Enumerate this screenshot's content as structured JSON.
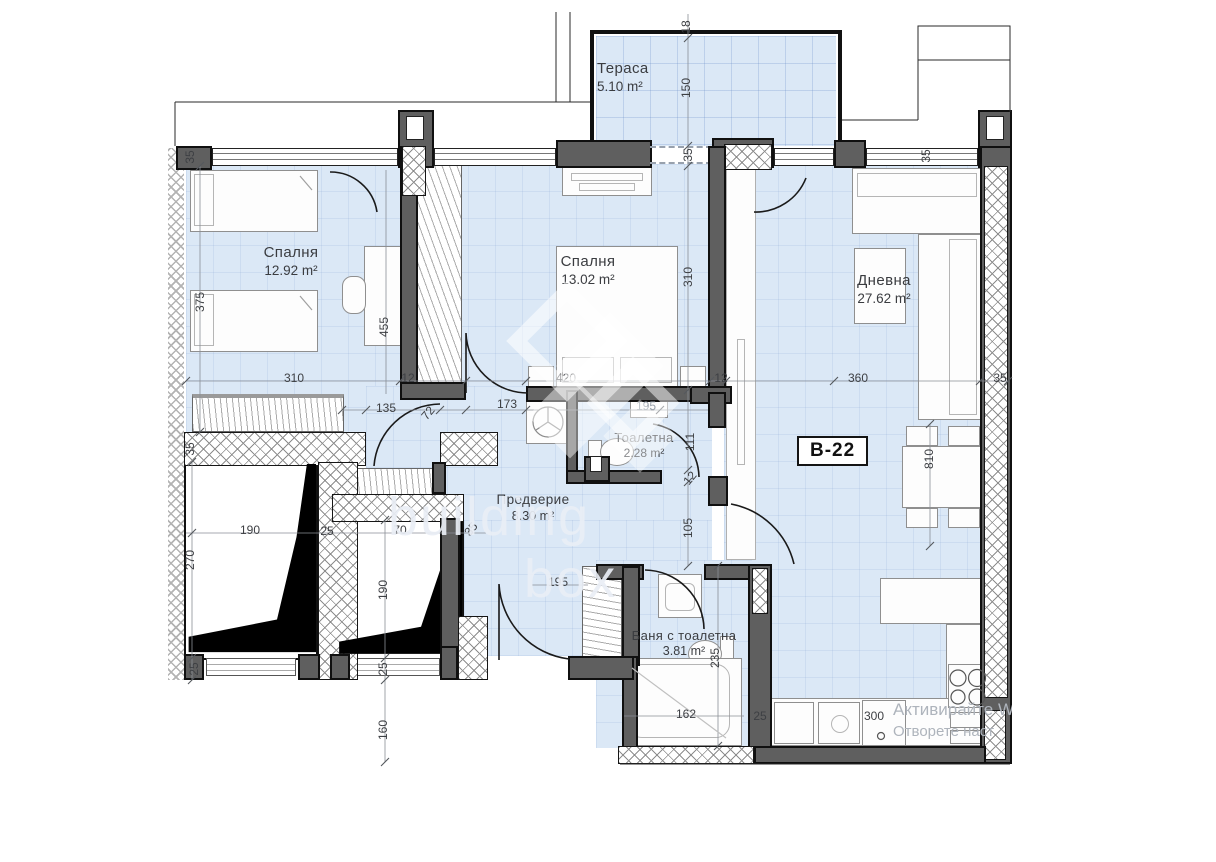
{
  "plan": {
    "unit_label": "B-22",
    "rooms": [
      {
        "name": "Тераса",
        "area": "5.10 m²"
      },
      {
        "name": "Спалня",
        "area": "12.92 m²"
      },
      {
        "name": "Спалня",
        "area": "13.02 m²"
      },
      {
        "name": "Дневна",
        "area": "27.62 m²"
      },
      {
        "name": "Тоалетна",
        "area": "2.28 m²"
      },
      {
        "name": "Предверие",
        "area": "8.30 m²"
      },
      {
        "name": "Баня с тоалетна",
        "area": "3.81 m²"
      }
    ],
    "dimensions": [
      {
        "t": "18",
        "x": 686,
        "y": 27,
        "o": "v"
      },
      {
        "t": "150",
        "x": 686,
        "y": 88,
        "o": "v"
      },
      {
        "t": "35",
        "x": 688,
        "y": 155,
        "o": "v"
      },
      {
        "t": "35",
        "x": 190,
        "y": 157,
        "o": "v"
      },
      {
        "t": "375",
        "x": 200,
        "y": 302,
        "o": "v"
      },
      {
        "t": "455",
        "x": 384,
        "y": 327,
        "o": "v"
      },
      {
        "t": "310",
        "x": 688,
        "y": 277,
        "o": "v"
      },
      {
        "t": "35",
        "x": 926,
        "y": 156,
        "o": "v"
      },
      {
        "t": "310",
        "x": 294,
        "y": 378,
        "o": "h"
      },
      {
        "t": "12",
        "x": 408,
        "y": 378,
        "o": "h"
      },
      {
        "t": "420",
        "x": 566,
        "y": 378,
        "o": "h"
      },
      {
        "t": "12",
        "x": 721,
        "y": 378,
        "o": "h"
      },
      {
        "t": "360",
        "x": 858,
        "y": 378,
        "o": "h"
      },
      {
        "t": "35",
        "x": 1000,
        "y": 378,
        "o": "h"
      },
      {
        "t": "135",
        "x": 386,
        "y": 408,
        "o": "h"
      },
      {
        "t": "72",
        "x": 428,
        "y": 413,
        "o": "d"
      },
      {
        "t": "173",
        "x": 507,
        "y": 404,
        "o": "h"
      },
      {
        "t": "195",
        "x": 646,
        "y": 406,
        "o": "h",
        "gray": true
      },
      {
        "t": "111",
        "x": 690,
        "y": 442,
        "o": "v"
      },
      {
        "t": "12",
        "x": 690,
        "y": 478,
        "o": "d"
      },
      {
        "t": "105",
        "x": 688,
        "y": 528,
        "o": "v"
      },
      {
        "t": "35",
        "x": 190,
        "y": 449,
        "o": "v"
      },
      {
        "t": "190",
        "x": 250,
        "y": 530,
        "o": "h"
      },
      {
        "t": "25",
        "x": 327,
        "y": 531,
        "o": "h"
      },
      {
        "t": "70",
        "x": 400,
        "y": 530,
        "o": "h"
      },
      {
        "t": "35",
        "x": 471,
        "y": 529,
        "o": "d"
      },
      {
        "t": "270",
        "x": 190,
        "y": 560,
        "o": "v"
      },
      {
        "t": "190",
        "x": 383,
        "y": 590,
        "o": "v"
      },
      {
        "t": "25",
        "x": 194,
        "y": 669,
        "o": "v"
      },
      {
        "t": "25",
        "x": 383,
        "y": 669,
        "o": "v"
      },
      {
        "t": "160",
        "x": 383,
        "y": 730,
        "o": "v"
      },
      {
        "t": "195",
        "x": 558,
        "y": 582,
        "o": "h"
      },
      {
        "t": "235",
        "x": 715,
        "y": 658,
        "o": "v"
      },
      {
        "t": "162",
        "x": 686,
        "y": 714,
        "o": "h"
      },
      {
        "t": "25",
        "x": 760,
        "y": 716,
        "o": "h"
      },
      {
        "t": "300",
        "x": 874,
        "y": 716,
        "o": "h"
      },
      {
        "t": "810",
        "x": 929,
        "y": 459,
        "o": "v"
      }
    ],
    "watermark": {
      "brand_line1": "building",
      "brand_line2": "box"
    },
    "os_watermark": {
      "line1": "Активирайте W",
      "line2": "Отворете наст"
    }
  }
}
